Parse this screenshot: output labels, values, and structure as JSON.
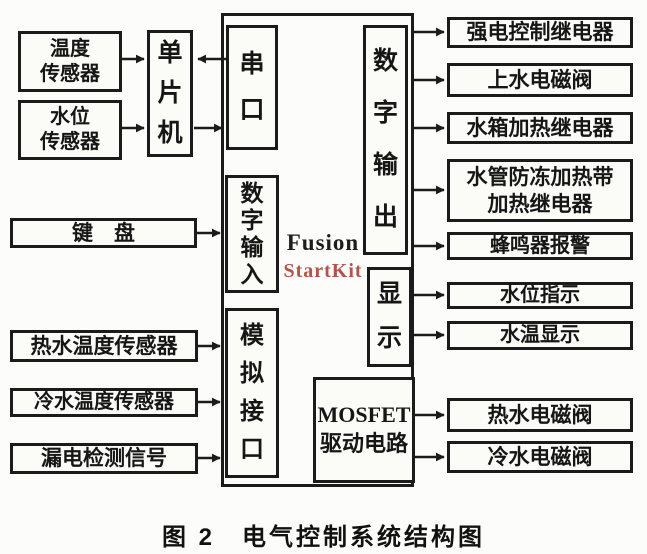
{
  "caption": "图 2　电气控制系统结构图",
  "core": {
    "mcu": "单片机",
    "serial_port": "串口",
    "digital_input": "数字输入",
    "analog_interface": "模拟接口",
    "digital_output": "数字输出",
    "display": "显示",
    "mosfet_line1": "MOSFET",
    "mosfet_line2": "驱动电路",
    "board_line1": "Fusion",
    "board_line2": "StartKit"
  },
  "inputs": {
    "temp_sensor_line1": "温度",
    "temp_sensor_line2": "传感器",
    "level_sensor_line1": "水位",
    "level_sensor_line2": "传感器",
    "keyboard": "键　盘",
    "hot_water_temp_sensor": "热水温度传感器",
    "cold_water_temp_sensor": "冷水温度传感器",
    "leakage_signal": "漏电检测信号"
  },
  "outputs": {
    "digital": [
      "强电控制继电器",
      "上水电磁阀",
      "水箱加热继电器",
      {
        "line1": "水管防冻加热带",
        "line2": "加热继电器"
      },
      "蜂鸣器报警"
    ],
    "display": [
      "水位指示",
      "水温显示"
    ],
    "mosfet": [
      "热水电磁阀",
      "冷水电磁阀"
    ]
  },
  "colors": {
    "ink": "#1b1b1b",
    "watermark_red": "#b3544a",
    "paper": "#fcfcfa"
  }
}
